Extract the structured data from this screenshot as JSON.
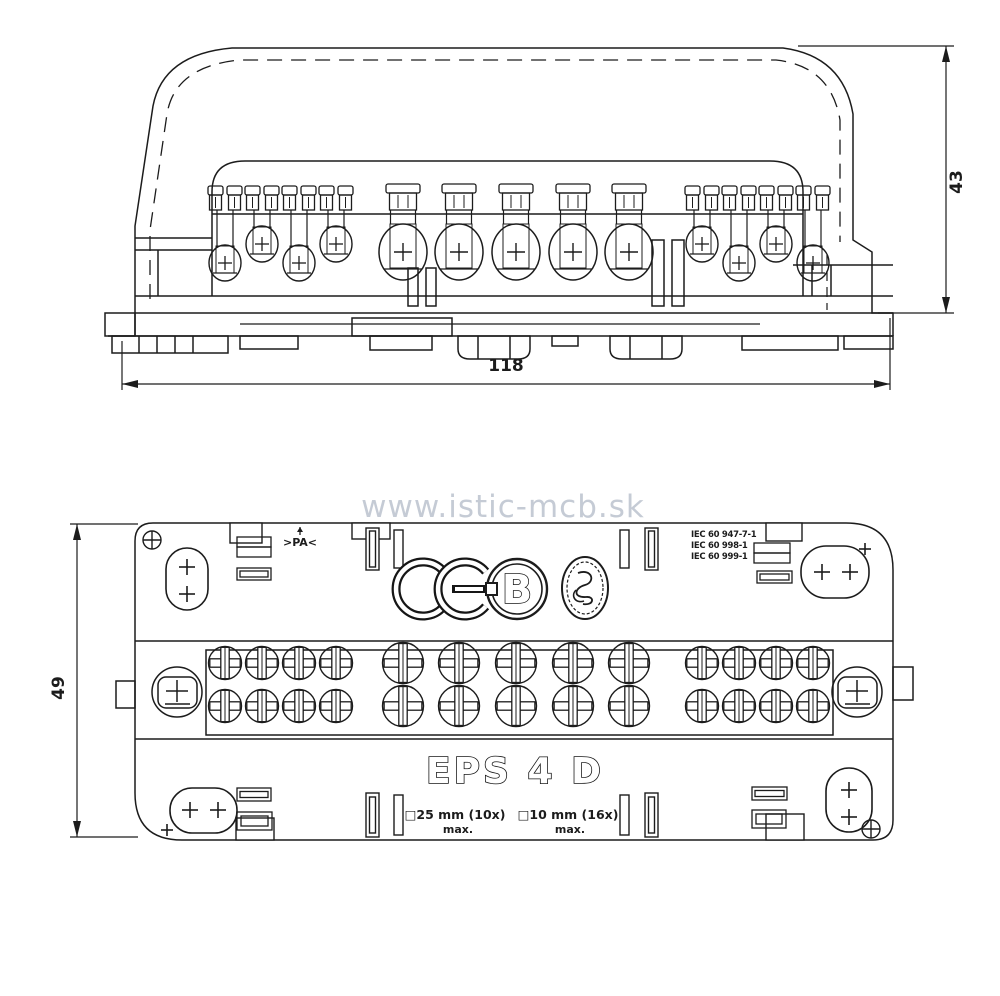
{
  "watermark": "www.istic-mcb.sk",
  "front_view": {
    "width_dim": "118",
    "height_dim": "43",
    "terminals": {
      "small": [
        {
          "x": 225,
          "pos": "low"
        },
        {
          "x": 262,
          "pos": "high"
        },
        {
          "x": 299,
          "pos": "low"
        },
        {
          "x": 336,
          "pos": "high"
        },
        {
          "x": 702,
          "pos": "high"
        },
        {
          "x": 739,
          "pos": "low"
        },
        {
          "x": 776,
          "pos": "high"
        },
        {
          "x": 813,
          "pos": "low"
        }
      ],
      "large_x": [
        403,
        459,
        516,
        573,
        629
      ]
    }
  },
  "plan_view": {
    "height_dim": "49",
    "model_label": "EPS 4 D",
    "material_marking": ">PA<",
    "standards": [
      "IEC 60 947-7-1",
      "IEC 60 998-1",
      "IEC 60 999-1"
    ],
    "certification_marks": {
      "ce_mark": "CE",
      "b_mark": "B"
    },
    "wire_specs": [
      {
        "size": "□25 mm (10x)",
        "max": "max."
      },
      {
        "size": "□10 mm (16x)",
        "max": "max."
      }
    ],
    "screws": {
      "rows_y": [
        663,
        706
      ],
      "small_x": [
        225,
        262,
        299,
        336,
        702,
        739,
        776,
        813
      ],
      "large_x": [
        403,
        459,
        516,
        573,
        629
      ],
      "small_r": 16.5,
      "large_r": 20.5
    }
  }
}
